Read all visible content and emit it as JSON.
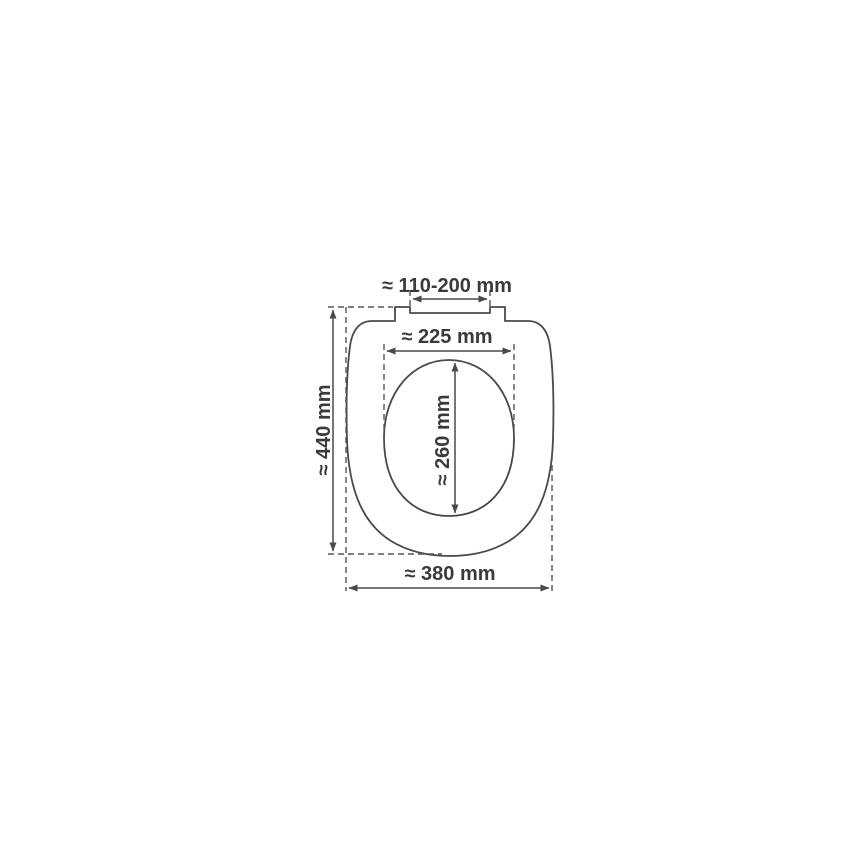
{
  "diagram": {
    "kind": "technical-dimension-drawing",
    "subject": "toilet-seat-top-view",
    "colors": {
      "background": "#ffffff",
      "line": "#4a4a4a",
      "dashed_line": "#555555",
      "text": "#3a3a3a"
    },
    "dimensions": {
      "hinge_spacing": {
        "label": "≈ 110-200 mm",
        "value_mm": "110-200",
        "approx": true
      },
      "inner_width": {
        "label": "≈ 225 mm",
        "value_mm": "225",
        "approx": true
      },
      "outer_height": {
        "label": "≈ 440 mm",
        "value_mm": "440",
        "approx": true
      },
      "inner_height": {
        "label": "≈ 260 mm",
        "value_mm": "260",
        "approx": true
      },
      "outer_width": {
        "label": "≈ 380 mm",
        "value_mm": "380",
        "approx": true
      }
    }
  }
}
